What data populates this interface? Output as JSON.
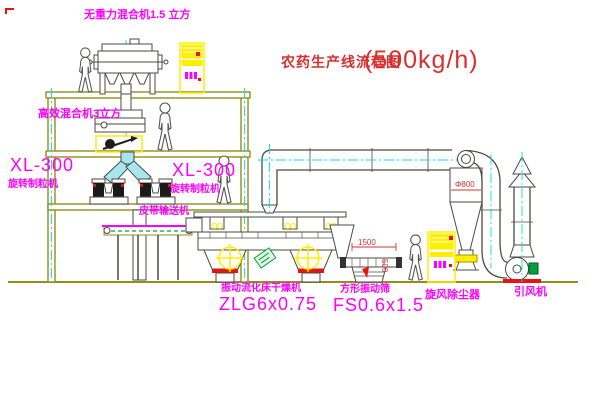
{
  "colors": {
    "background": "#ffffff",
    "line_olive": "#8f8f1a",
    "line_dark": "#4a4a42",
    "centerline_cyan": "#00e0e0",
    "label_magenta": "#ff00ff",
    "label_red": "#d83030",
    "fill_yellow": "#ffee00",
    "chute_cyan": "#a8e6ee",
    "motor_green": "#00a040",
    "base_red": "#ee1111"
  },
  "title": {
    "text": "农药生产线流程图",
    "capacity": "(500kg/h)"
  },
  "equipment_labels": {
    "gravity_free_mixer": "无重力混合机1.5 立方",
    "high_eff_mixer": "高效混合机3立方",
    "granulator_left": {
      "model": "XL-300",
      "name": "旋转制粒机"
    },
    "granulator_right": {
      "model": "XL-300",
      "name": "旋转制粒机"
    },
    "belt_conveyor": "皮带输送机",
    "fluid_bed_dryer": {
      "name": "振动流化床干燥机",
      "model": "ZLG6x0.75"
    },
    "vibrating_screen": {
      "name": "方形振动筛",
      "model": "FS0.6x1.5"
    },
    "cyclone": "旋风除尘器",
    "induced_draft_fan": "引风机"
  },
  "dimensions": {
    "screen_width": "1500",
    "screen_height": "500",
    "cyclone_dia": "Φ800"
  }
}
